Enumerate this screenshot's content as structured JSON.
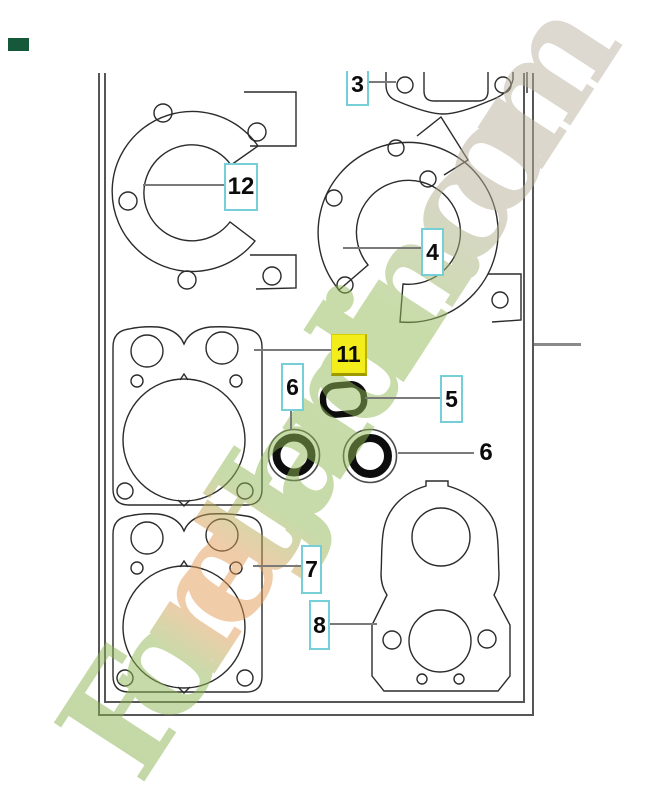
{
  "watermark": {
    "text": "ForetJardin.com"
  },
  "corner_badge": {
    "color": "#15593a"
  },
  "colors": {
    "callout_border": "#76ced6",
    "highlight_fill": "#f2ed1b",
    "leader_line": "#7a7a7a",
    "drawing_line": "#2b2b2b",
    "watermark_green": "#8fb855",
    "watermark_orange": "#e59a55",
    "watermark_tan": "#bdb5a4"
  },
  "parts": [
    {
      "number": "3",
      "highlighted": false
    },
    {
      "number": "12",
      "highlighted": false
    },
    {
      "number": "4",
      "highlighted": false
    },
    {
      "number": "11",
      "highlighted": true
    },
    {
      "number": "5",
      "highlighted": false
    },
    {
      "number": "6",
      "highlighted": false
    },
    {
      "number": "6",
      "highlighted": false
    },
    {
      "number": "7",
      "highlighted": false
    },
    {
      "number": "8",
      "highlighted": false
    }
  ]
}
